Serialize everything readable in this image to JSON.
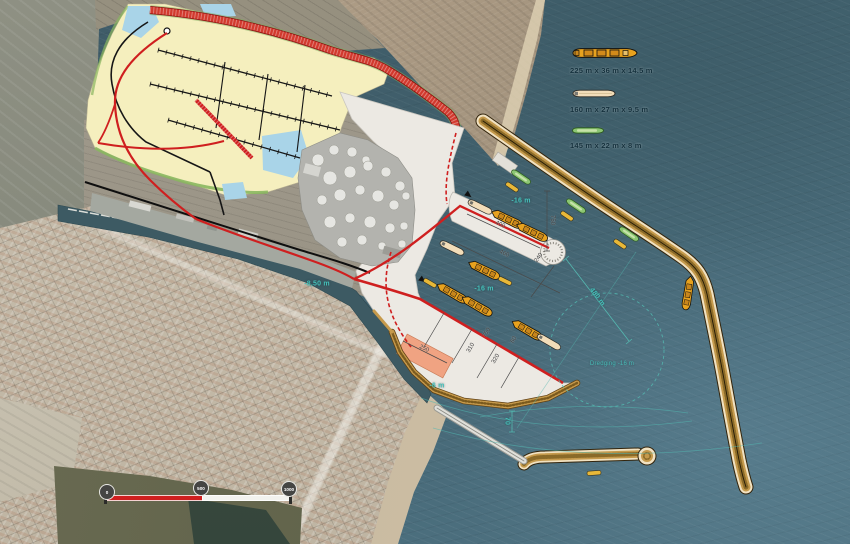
{
  "legend": {
    "items": [
      {
        "name": "bulk-carrier",
        "label": "225 m x 36 m x 14.5 m",
        "ship_color": "#e8a21e"
      },
      {
        "name": "general-cargo-vessel",
        "label": "160 m x 27 m x 9.5 m",
        "ship_color": "#f2ddb9"
      },
      {
        "name": "coaster-vessel",
        "label": "145 m x 22 m x 8 m",
        "ship_color": "#8cc673"
      }
    ]
  },
  "scale_bar": {
    "tick_labels": [
      "0",
      "500",
      "1000"
    ]
  },
  "annotations": {
    "labels": [
      {
        "text": "-16 m"
      },
      {
        "text": "-16 m"
      },
      {
        "text": "-8,50 m"
      },
      {
        "text": "-6 m"
      },
      {
        "text": "Dredging -16 m"
      },
      {
        "text": "480 m"
      },
      {
        "text": "70"
      },
      {
        "text": "400"
      },
      {
        "text": "460"
      },
      {
        "text": "240"
      },
      {
        "text": "750"
      },
      {
        "text": "750"
      },
      {
        "text": "60"
      },
      {
        "text": "310"
      },
      {
        "text": "320"
      },
      {
        "text": "250"
      }
    ]
  },
  "colors": {
    "sea": "#43616e",
    "platform": "#ece9e3",
    "development_zone_yellow": "#f5efbe",
    "accent_red": "#cf1f1f",
    "breakwater_tan": "#c59a4c",
    "breakwater_cream": "#f1e2c2",
    "annotation_teal": "#46c0ba",
    "ship_orange": "#e8a21e",
    "ship_cream": "#f2ddb9",
    "ship_green": "#8cc673",
    "quay_salmon": "#f0a382"
  }
}
